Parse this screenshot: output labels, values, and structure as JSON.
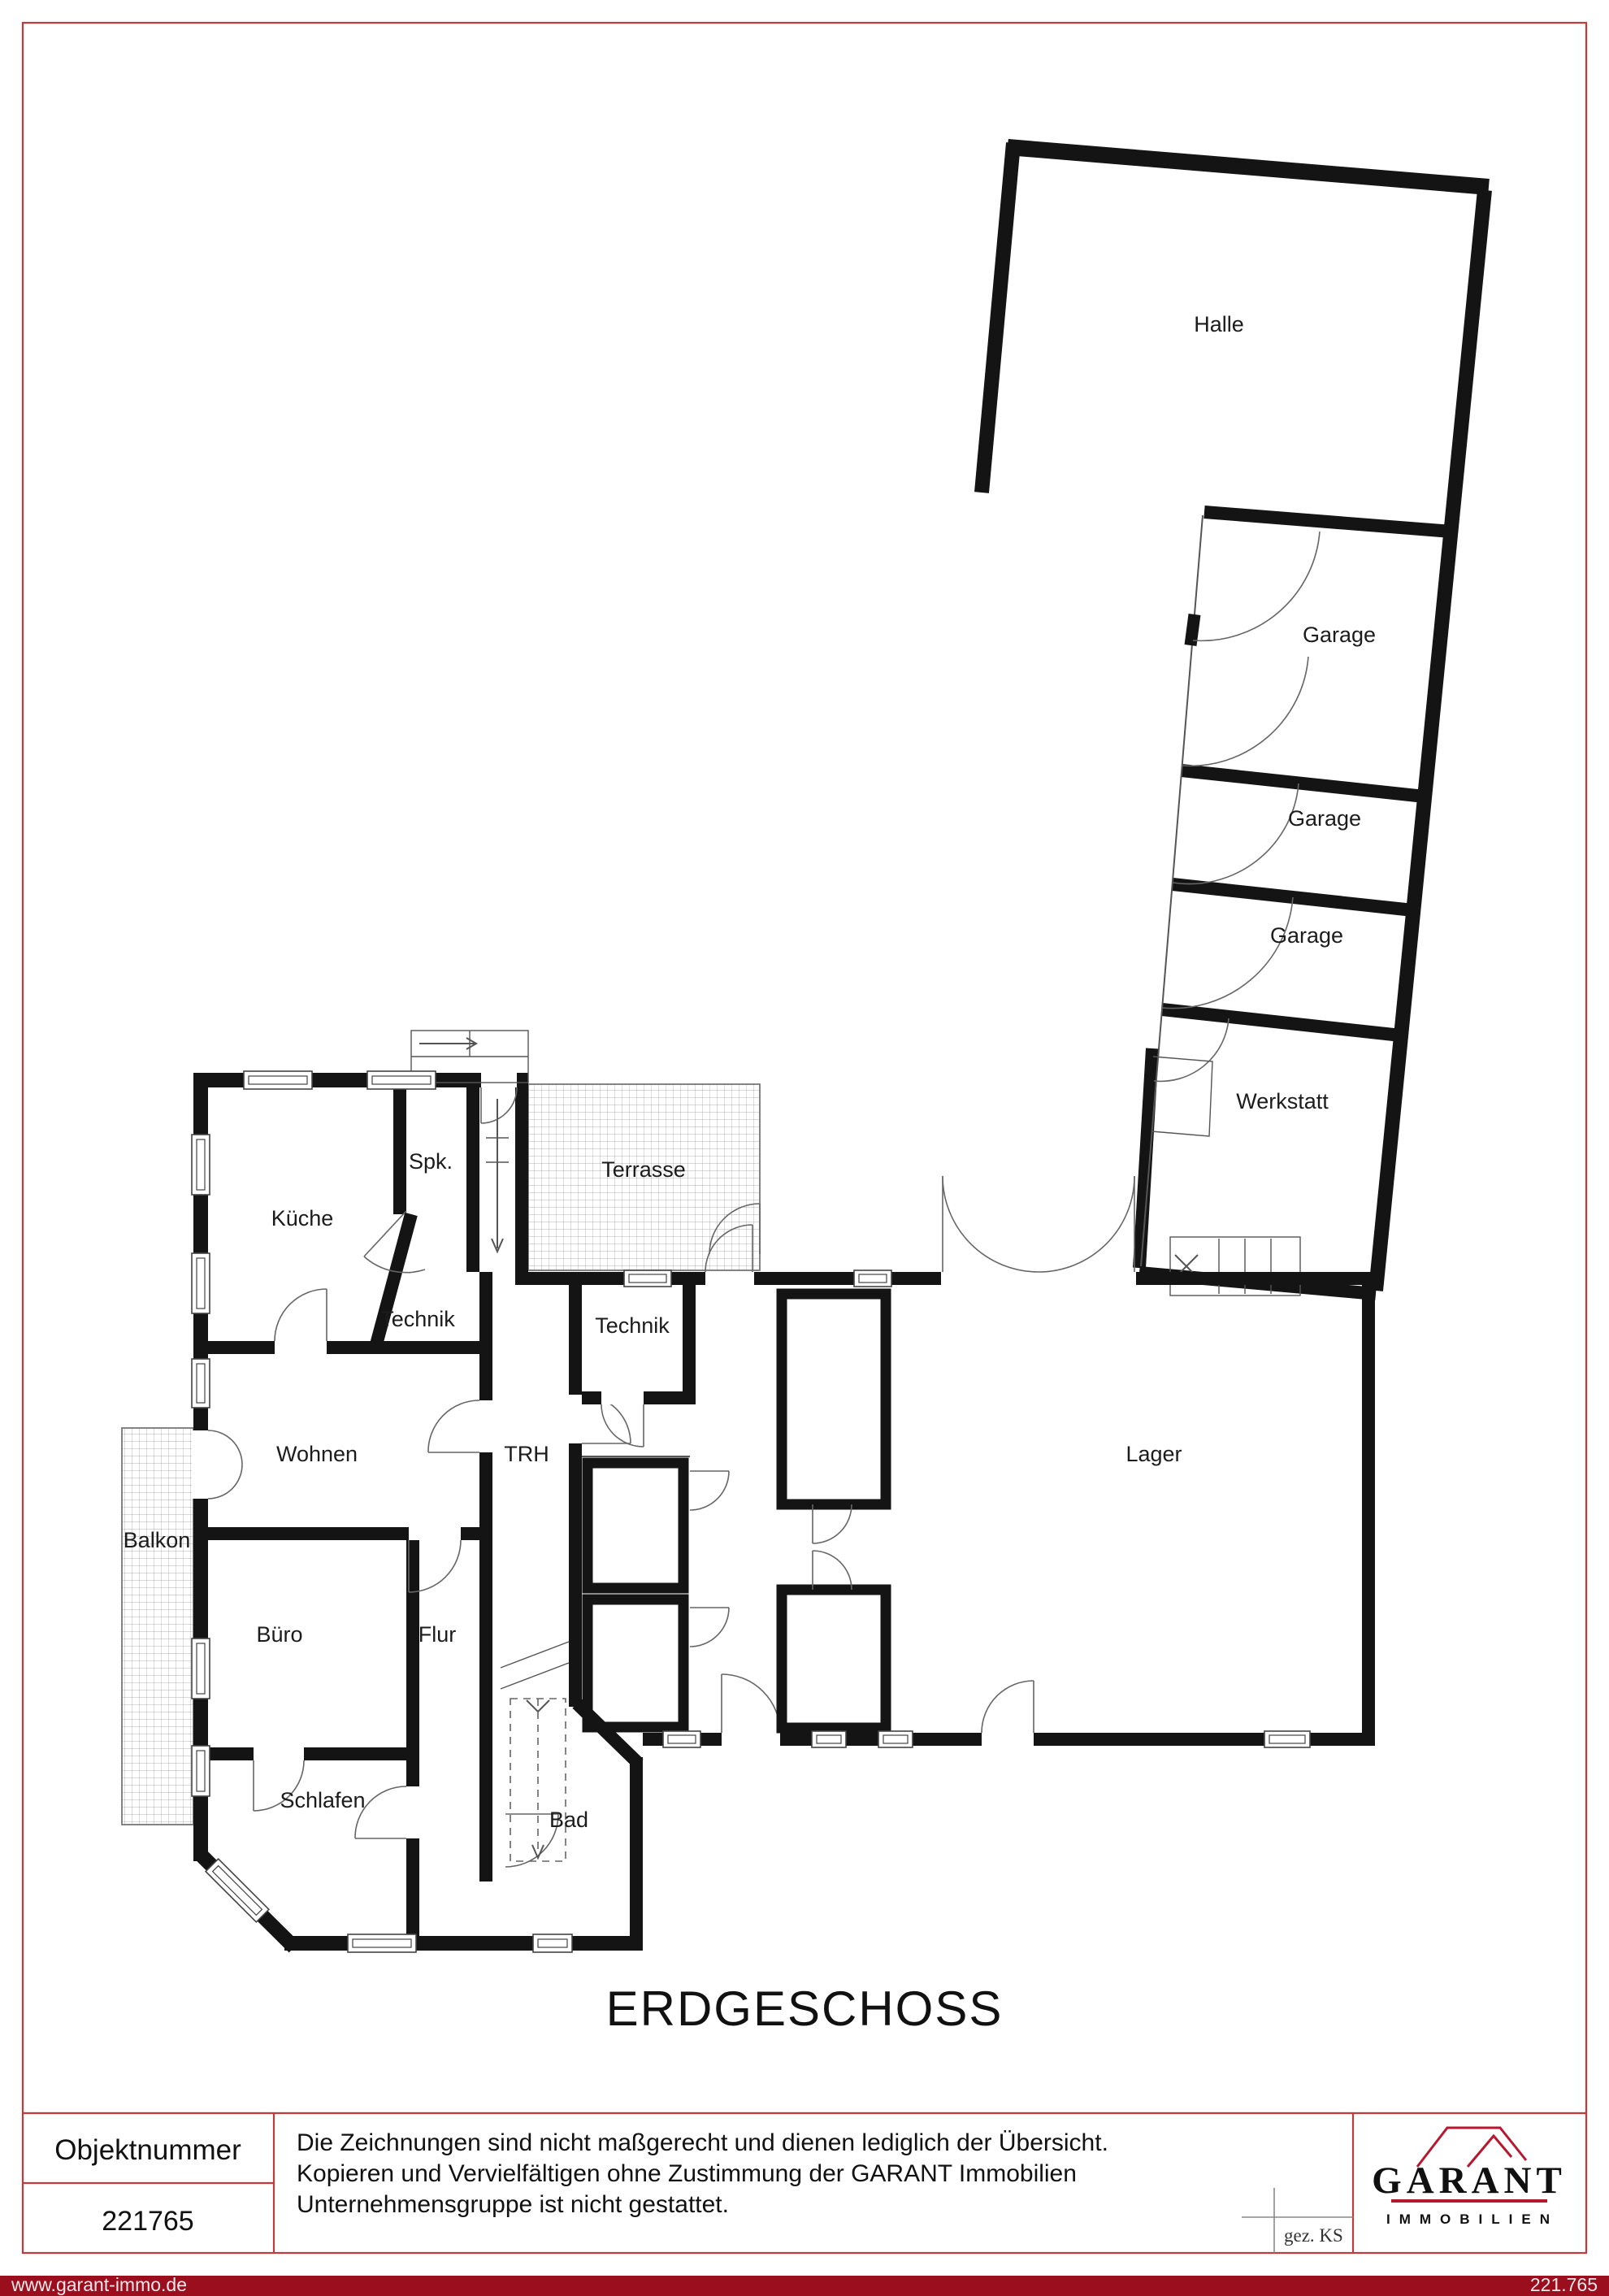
{
  "plan": {
    "floor_title": "ERDGESCHOSS",
    "rooms": {
      "halle": "Halle",
      "garage1": "Garage",
      "garage2": "Garage",
      "garage3": "Garage",
      "werkstatt": "Werkstatt",
      "terrasse": "Terrasse",
      "spk": "Spk.",
      "kueche": "Küche",
      "technik_links": "Technik",
      "technik_rechts": "Technik",
      "wohnen": "Wohnen",
      "trh": "TRH",
      "lager": "Lager",
      "balkon": "Balkon",
      "buero": "Büro",
      "flur": "Flur",
      "schlafen": "Schlafen",
      "bad": "Bad"
    }
  },
  "title_block": {
    "object_number_label": "Objektnummer",
    "object_number_value": "221765",
    "disclaimer_line1": "Die Zeichnungen sind nicht maßgerecht und dienen lediglich der Übersicht.",
    "disclaimer_line2": "Kopieren und Vervielfältigen ohne Zustimmung der GARANT Immobilien",
    "disclaimer_line3": "Unternehmensgruppe ist nicht gestattet.",
    "signed_label": "gez. KS",
    "logo": {
      "name": "GARANT",
      "subtitle": "IMMOBILIEN"
    }
  },
  "footer": {
    "website": "www.garant-immo.de",
    "object_number": "221.765"
  },
  "colors": {
    "wall": "#141414",
    "border_red": "#c13b3b",
    "footer_red": "#9a0e1d",
    "logo_red": "#b5182f",
    "hatch": "#9a9a9a"
  }
}
